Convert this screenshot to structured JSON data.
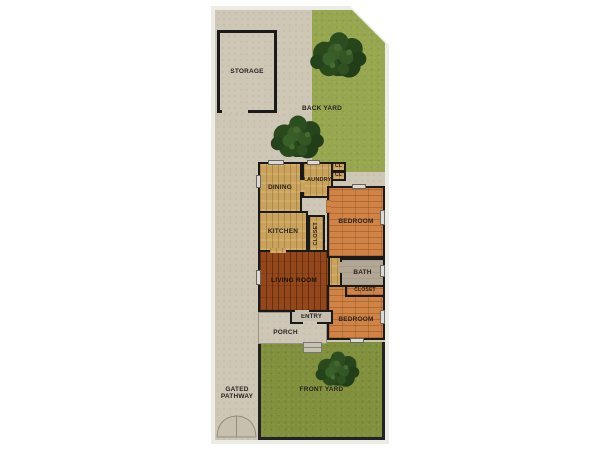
{
  "plan": {
    "areas": {
      "storage": "STORAGE",
      "back_yard": "BACK YARD",
      "front_yard": "FRONT YARD",
      "pathway_line1": "GATED",
      "pathway_line2": "PATHWAY",
      "porch": "PORCH",
      "entry": "ENTRY"
    },
    "rooms": {
      "dining": "DINING",
      "laundry": "LAUNDRY",
      "closet_small_1": "CL",
      "closet_small_2": "CL",
      "kitchen": "KITCHEN",
      "hall_closet": "CLOSET",
      "bedroom_1": "BEDROOM",
      "living_room": "LIVING ROOM",
      "bath": "BATH",
      "bedroom_closet": "CLOSET",
      "bedroom_2": "BEDROOM"
    },
    "colors": {
      "concrete": "#cfc7b6",
      "grass_back": "#97a74f",
      "grass_front": "#80903c",
      "wood_light": "#c9a35c",
      "wood_orange": "#cf8446",
      "wood_dark": "#93471b",
      "bath_floor": "#b2a694",
      "wall": "#1a1a1a",
      "tree": "#2a4a1e"
    }
  }
}
